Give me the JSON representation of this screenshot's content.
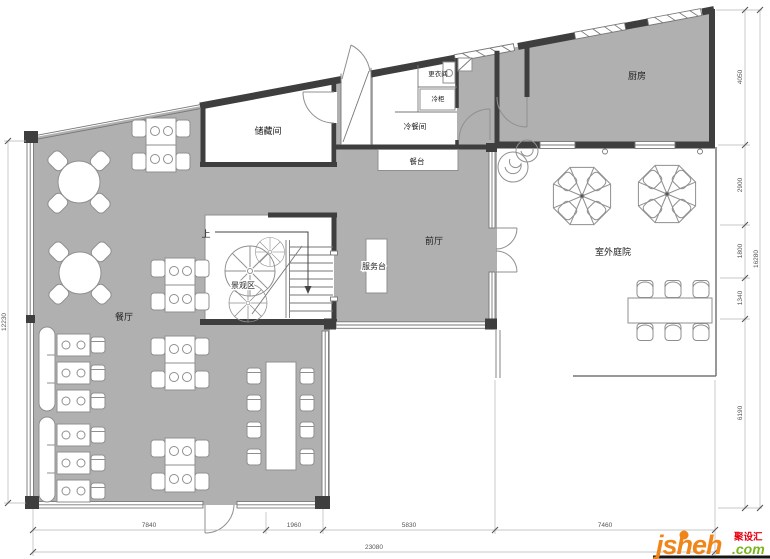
{
  "plan": {
    "rooms": {
      "dining_hall": "餐厅",
      "kitchen": "厨房",
      "storage": "储藏间",
      "changing_room": "更衣间",
      "cold_cabinet": "冷柜",
      "cold_food_room": "冷餐间",
      "buffet_counter": "餐台",
      "front_hall": "前厅",
      "service_desk": "服务台",
      "landscape_area": "景观区",
      "outdoor_courtyard": "室外庭院",
      "stairs_up": "上"
    },
    "dimensions": {
      "bottom": [
        "7840",
        "1960",
        "5830",
        "7460"
      ],
      "bottom_total": "23080",
      "left_total": "12230",
      "right": [
        "4050",
        "2900",
        "1800",
        "1340",
        "6190"
      ],
      "right_total": "16280"
    }
  },
  "watermark": {
    "brand": "jsheh",
    "cn": "聚设汇",
    "tld": ".com"
  },
  "colors": {
    "floor": "#b0b0b0",
    "wall": "#3e3e3e",
    "brand_orange": "#f08619",
    "brand_green": "#7ab51d",
    "brand_red": "#e60012"
  }
}
